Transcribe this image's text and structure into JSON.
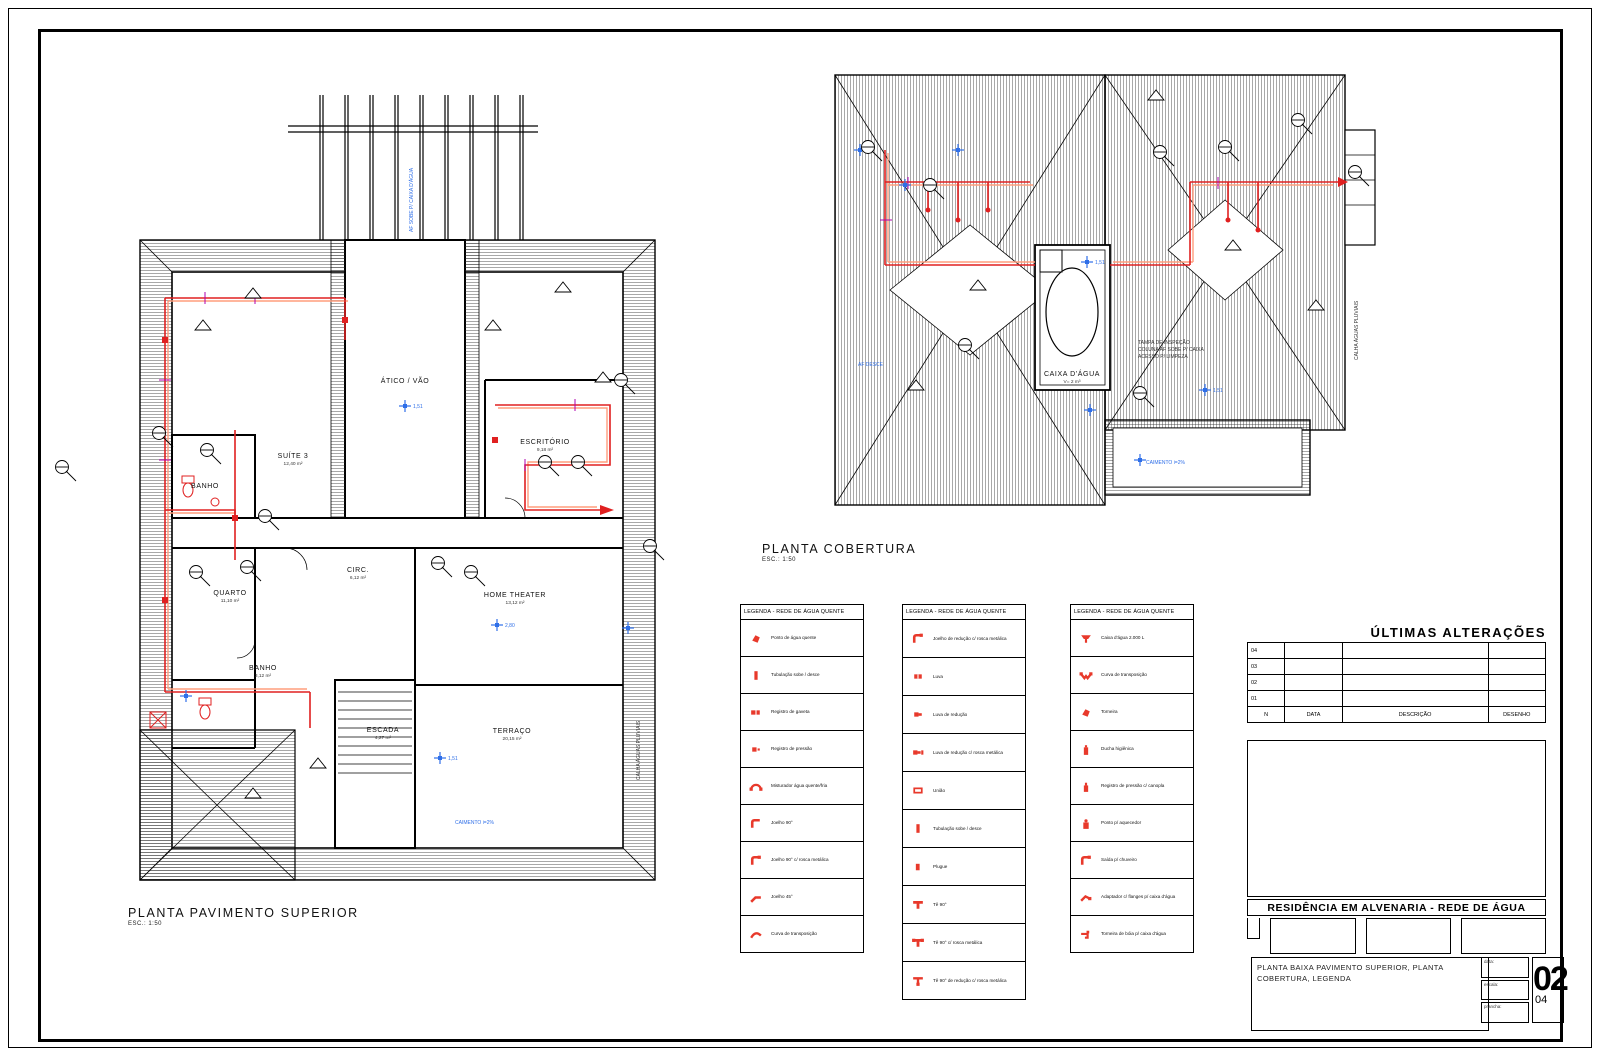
{
  "plans": {
    "superior": {
      "title": "PLANTA PAVIMENTO SUPERIOR",
      "scale": "ESC.: 1:50",
      "rooms": [
        {
          "name": "ÁTICO / VÃO",
          "area": "",
          "x": 350,
          "y": 303
        },
        {
          "name": "SUÍTE 3",
          "area": "12,40 m²",
          "x": 238,
          "y": 378
        },
        {
          "name": "ESCRITÓRIO",
          "area": "9,18 m²",
          "x": 490,
          "y": 364
        },
        {
          "name": "QUARTO",
          "area": "11,10 m²",
          "x": 175,
          "y": 515
        },
        {
          "name": "CIRC.",
          "area": "6,12 m²",
          "x": 303,
          "y": 492
        },
        {
          "name": "HOME THEATER",
          "area": "13,12 m²",
          "x": 460,
          "y": 517
        },
        {
          "name": "BANHO",
          "area": "3,12 m²",
          "x": 208,
          "y": 590
        },
        {
          "name": "ESCADA",
          "area": "4,27 m²",
          "x": 328,
          "y": 652
        },
        {
          "name": "TERRAÇO",
          "area": "20,15 m²",
          "x": 457,
          "y": 653
        },
        {
          "name": "BANHO",
          "area": "",
          "x": 150,
          "y": 408
        }
      ],
      "levels": [
        {
          "x": 350,
          "y": 326,
          "label": "1,51"
        },
        {
          "x": 442,
          "y": 545,
          "label": "2,80"
        },
        {
          "x": 385,
          "y": 678,
          "label": "1,51"
        },
        {
          "x": 573,
          "y": 548,
          "label": ""
        },
        {
          "x": 131,
          "y": 616,
          "label": ""
        }
      ],
      "notes": [
        {
          "text": "AF SOBE P/ CAIXA D'ÁGUA",
          "x": 358,
          "y": 152,
          "rot": -90,
          "color": "#2f6fe8"
        },
        {
          "text": "CAIMENTO i=2%",
          "x": 400,
          "y": 744,
          "rot": 0,
          "color": "#2f6fe8"
        },
        {
          "text": "CALHA ÁGUAS PLUVIAIS",
          "x": 585,
          "y": 700,
          "rot": -90,
          "color": "#333333"
        }
      ],
      "callouts": [
        [
          7,
          387
        ],
        [
          152,
          370
        ],
        [
          210,
          436
        ],
        [
          192,
          487
        ],
        [
          141,
          492
        ],
        [
          383,
          483
        ],
        [
          416,
          492
        ],
        [
          490,
          382
        ],
        [
          523,
          382
        ],
        [
          566,
          300
        ],
        [
          595,
          466
        ],
        [
          104,
          353
        ]
      ],
      "triangles": [
        [
          140,
          250
        ],
        [
          190,
          218
        ],
        [
          430,
          250
        ],
        [
          500,
          212
        ],
        [
          190,
          718
        ],
        [
          255,
          688
        ],
        [
          540,
          302
        ]
      ]
    },
    "cobertura": {
      "title": "PLANTA COBERTURA",
      "scale": "ESC.: 1:50",
      "rooms": [
        {
          "name": "CAIXA D'ÁGUA",
          "area": "V= 2 m³",
          "x": 244,
          "y": 316
        }
      ],
      "levels": [
        {
          "x": 32,
          "y": 90,
          "label": ""
        },
        {
          "x": 77,
          "y": 125,
          "label": ""
        },
        {
          "x": 130,
          "y": 90,
          "label": ""
        },
        {
          "x": 259,
          "y": 202,
          "label": "1,51"
        },
        {
          "x": 262,
          "y": 350,
          "label": ""
        },
        {
          "x": 312,
          "y": 400,
          "label": ""
        },
        {
          "x": 377,
          "y": 330,
          "label": "1,51"
        }
      ],
      "notes": [
        {
          "text": "TAMPA DE INSPEÇÃO",
          "x": 310,
          "y": 284,
          "rot": 0,
          "color": "#333333"
        },
        {
          "text": "COLUNA AF SOBE P/ CAIXA",
          "x": 310,
          "y": 291,
          "rot": 0,
          "color": "#333333"
        },
        {
          "text": "ACESSO P/ LIMPEZA",
          "x": 310,
          "y": 298,
          "rot": 0,
          "color": "#333333"
        },
        {
          "text": "CAIMENTO i=2%",
          "x": 318,
          "y": 404,
          "rot": 0,
          "color": "#2f6fe8"
        },
        {
          "text": "CALHA ÁGUAS PLUVIAIS",
          "x": 530,
          "y": 300,
          "rot": -90,
          "color": "#333333"
        },
        {
          "text": "AF DESCE",
          "x": 30,
          "y": 306,
          "rot": 0,
          "color": "#2f6fe8"
        }
      ],
      "callouts": [
        [
          40,
          87
        ],
        [
          102,
          125
        ],
        [
          332,
          92
        ],
        [
          397,
          87
        ],
        [
          137,
          285
        ],
        [
          312,
          333
        ],
        [
          527,
          112
        ],
        [
          470,
          60
        ]
      ],
      "triangles": [
        [
          142,
          230
        ],
        [
          397,
          190
        ],
        [
          80,
          330
        ],
        [
          320,
          40
        ],
        [
          480,
          250
        ]
      ]
    }
  },
  "legends": [
    {
      "title": "LEGENDA - REDE DE ÁGUA QUENTE",
      "items": [
        {
          "icon": "point",
          "label": "Ponto de água quente"
        },
        {
          "icon": "riser",
          "label": "Tubulação sobe / desce"
        },
        {
          "icon": "valve",
          "label": "Registro de gaveta"
        },
        {
          "icon": "valve2",
          "label": "Registro de pressão"
        },
        {
          "icon": "arch",
          "label": "Misturador água quente/fria"
        },
        {
          "icon": "elbow",
          "label": "Joelho 90°"
        },
        {
          "icon": "elbow2",
          "label": "Joelho 90° c/ rosca metálica"
        },
        {
          "icon": "elbow45",
          "label": "Joelho 45°"
        },
        {
          "icon": "curve",
          "label": "Curva de transposição"
        }
      ]
    },
    {
      "title": "LEGENDA - REDE DE ÁGUA QUENTE",
      "items": [
        {
          "icon": "elbow2",
          "label": "Joelho de redução c/ rosca metálica"
        },
        {
          "icon": "sleeve",
          "label": "Luva"
        },
        {
          "icon": "sleeve2",
          "label": "Luva de redução"
        },
        {
          "icon": "sleeve3",
          "label": "Luva de redução c/ rosca metálica"
        },
        {
          "icon": "union",
          "label": "União"
        },
        {
          "icon": "riser",
          "label": "Tubulação sobe / desce"
        },
        {
          "icon": "plug",
          "label": "Plugue"
        },
        {
          "icon": "tee",
          "label": "Tê 90°"
        },
        {
          "icon": "tee2",
          "label": "Tê 90° c/ rosca metálica"
        },
        {
          "icon": "tee3",
          "label": "Tê 90° de redução c/ rosca metálica"
        }
      ]
    },
    {
      "title": "LEGENDA - REDE DE ÁGUA QUENTE",
      "items": [
        {
          "icon": "tank",
          "label": "Caixa d'água 2.000 L"
        },
        {
          "icon": "vee",
          "label": "Curva de transposição"
        },
        {
          "icon": "point",
          "label": "Torneira"
        },
        {
          "icon": "heater",
          "label": "Ducha higiênica"
        },
        {
          "icon": "bottle",
          "label": "Registro de pressão c/ canopla"
        },
        {
          "icon": "bottle2",
          "label": "Ponto p/ aquecedor"
        },
        {
          "icon": "elbow2",
          "label": "Saída p/ chuveiro"
        },
        {
          "icon": "adapter",
          "label": "Adaptador c/ flanges p/ caixa d'água"
        },
        {
          "icon": "tap",
          "label": "Torneira de bóia p/ caixa d'água"
        }
      ]
    }
  ],
  "revisions": {
    "title": "ÚLTIMAS ALTERAÇÕES",
    "rows": [
      "04",
      "03",
      "02",
      "01"
    ],
    "headers": [
      "N",
      "DATA",
      "DESCRIÇÃO",
      "DESENHO"
    ]
  },
  "titleblock": {
    "project": "RESIDÊNCIA EM ALVENARIA - REDE DE ÁGUA",
    "content": "PLANTA BAIXA PAVIMENTO SUPERIOR, PLANTA COBERTURA, LEGENDA",
    "fields": [
      "data:",
      "escala:",
      "prancha:"
    ],
    "sheet_number": "02",
    "sheet_total": "04"
  },
  "colors": {
    "pipe_cold": "#e02020",
    "pipe_hot": "#ff9d7d",
    "pipe_tick": "#b000b0",
    "marker_blue": "#2f6fe8",
    "legend_red": "#e8392b"
  }
}
